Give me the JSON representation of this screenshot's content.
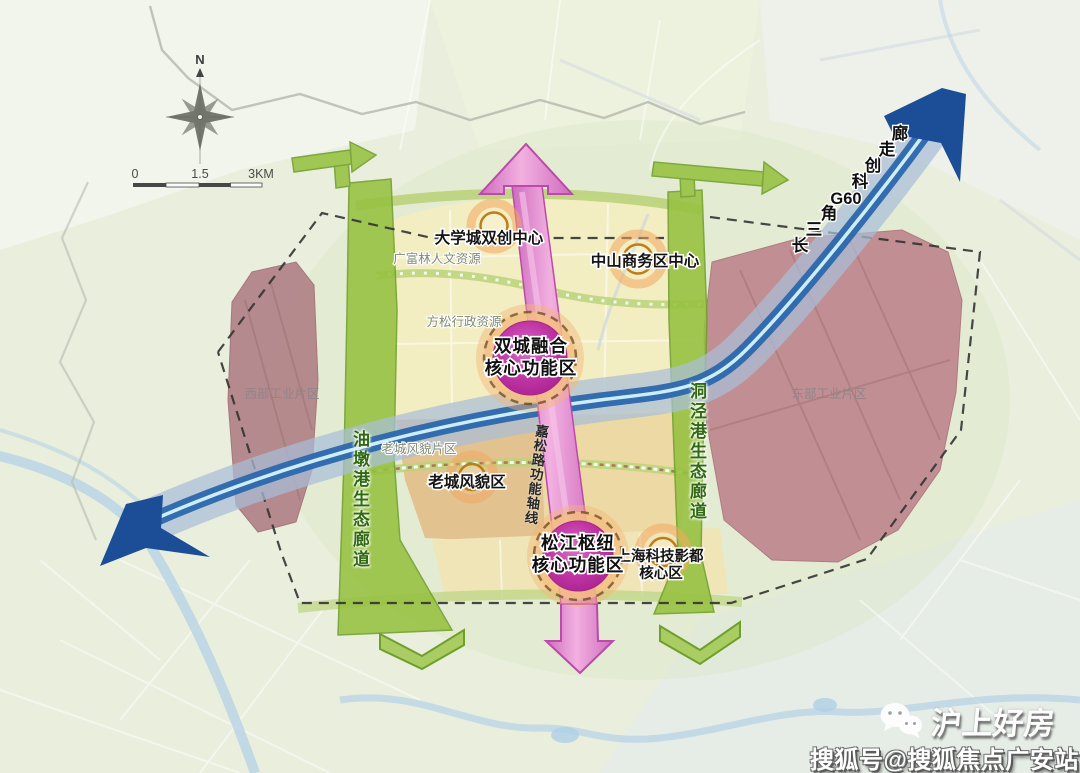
{
  "compass": {
    "north": "N"
  },
  "scale_bar": {
    "zero": "0",
    "mid": "1.5",
    "end": "3KM"
  },
  "g60": {
    "label": "长三角G60科创走廊",
    "chars": [
      "长",
      "三",
      "角",
      "G60",
      "科",
      "创",
      "走",
      "廊"
    ]
  },
  "corridors": {
    "west_eco": "油墩港生态廊道",
    "east_eco": "洞泾港生态廊道"
  },
  "axis": {
    "label": "嘉松路功能轴线"
  },
  "zones": {
    "west_industrial": "西部工业片区",
    "east_industrial": "东部工业片区",
    "old_town_area": "老城风貌片区"
  },
  "resources": {
    "guangfulin": "广富林人文资源",
    "fangsong": "方松行政资源"
  },
  "centers": {
    "university": "大学城双创中心",
    "zhongshan": "中山商务区中心",
    "old_town": "老城风貌区",
    "film_line1": "上海科技影都",
    "film_line2": "核心区"
  },
  "cores": {
    "twin_line1": "双城融合",
    "twin_line2": "核心功能区",
    "hub_line1": "松江枢纽",
    "hub_line2": "核心功能区"
  },
  "watermark": {
    "brand": "沪上好房",
    "account": "搜狐号@搜狐焦点广安站"
  },
  "colors": {
    "background": "#e9eedd",
    "zone_yellow": "#f3edc2",
    "zone_tan": "#e2c28e",
    "industry_maroon": "#b98a8f",
    "eco_green": "#96c140",
    "ring_road_green": "#bad37b",
    "corridor_blue_band": "#a9bed7",
    "corridor_blue_dark": "#2b67ad",
    "axis_pink": "#e9a0d5",
    "core_magenta": "#bb2f9f",
    "center_orange": "#d9913c"
  }
}
